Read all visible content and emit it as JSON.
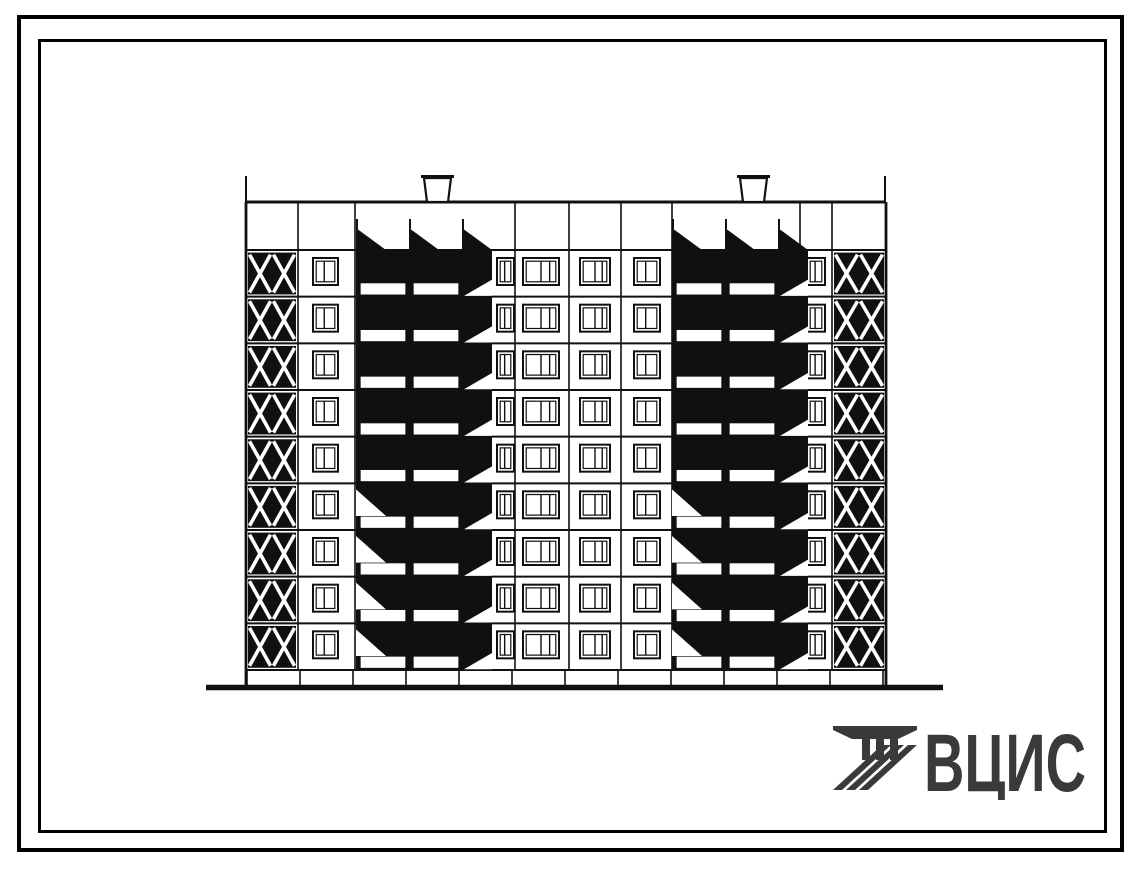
{
  "page": {
    "background": "#ffffff",
    "frame_color": "#000000"
  },
  "logo": {
    "text": "ВЦИС",
    "color": "#3a3a3c"
  },
  "elevation": {
    "title_semantic": "nine-storey-panel-building-rear-elevation",
    "ink": "#101010",
    "paper": "#ffffff",
    "floors": 9,
    "body": {
      "left": 246,
      "right": 886,
      "parapet_top": 202,
      "attic_bottom": 250,
      "base_top": 670,
      "base_bottom": 688
    },
    "ground_line": {
      "x0": 206,
      "x1": 943,
      "y": 687.5,
      "thickness": 5.5
    },
    "parapet_ticks": [
      246,
      885
    ],
    "tick_top_y": 176,
    "roof_shafts": [
      {
        "x": 424,
        "w": 27
      },
      {
        "x": 740,
        "w": 27
      }
    ],
    "shaft_top_y": 175,
    "joints": [
      298,
      355,
      515,
      569,
      621,
      672,
      800,
      832
    ],
    "basement_joint_step": 53,
    "x_brace_bays": [
      {
        "x0": 246,
        "x1": 298
      },
      {
        "x0": 832,
        "x1": 886
      }
    ],
    "window_columns": [
      {
        "x": 313,
        "w": 25,
        "panes": 2
      },
      {
        "x": 497,
        "w": 17,
        "panes": 2
      },
      {
        "x": 523,
        "w": 36,
        "panes": 3
      },
      {
        "x": 580,
        "w": 30,
        "panes": 3
      },
      {
        "x": 634,
        "w": 26,
        "panes": 2
      },
      {
        "x": 807,
        "w": 18,
        "panes": 2
      }
    ],
    "balcony_stacks": [
      {
        "x0": 356,
        "cell_w": 53,
        "cells": 2,
        "shadow_w": 30,
        "peak_h": 22,
        "light_wedge_floors": [
          5,
          6,
          7,
          8
        ]
      },
      {
        "x0": 672,
        "cell_w": 53,
        "cells": 2,
        "shadow_w": 30,
        "peak_h": 22,
        "light_wedge_floors": [
          5,
          6,
          7,
          8
        ]
      }
    ]
  }
}
